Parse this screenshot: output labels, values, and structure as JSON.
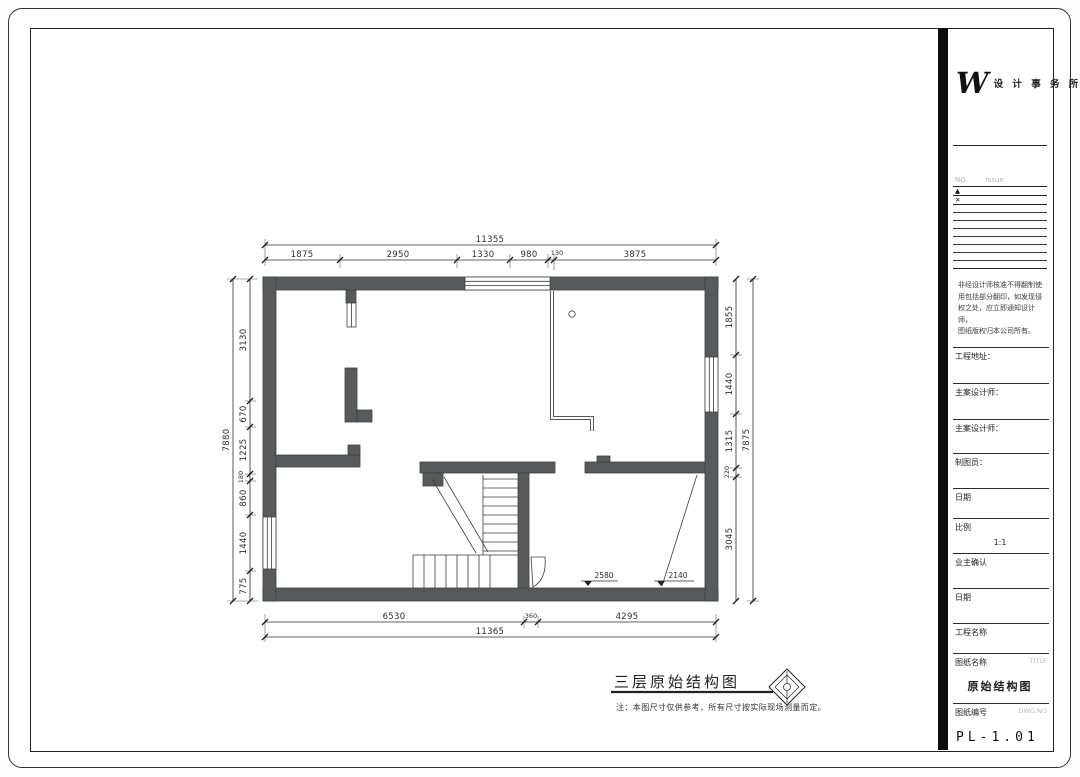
{
  "sheet": {
    "page_title": "三层原始结构图",
    "title_note": "注：本图尺寸仅供参考，所有尺寸按实际现场测量而定。",
    "wall_color": "#58595b",
    "line_color": "#3c3c3c"
  },
  "plan": {
    "dims_top": {
      "overall": "11355",
      "segments": [
        "1875",
        "2950",
        "1330",
        "980",
        "130",
        "3875"
      ]
    },
    "dims_bottom": {
      "overall": "11365",
      "segments": [
        "6530",
        "360",
        "4295"
      ]
    },
    "dims_left": {
      "overall": "7880",
      "segments": [
        "3130",
        "670",
        "1225",
        "180",
        "860",
        "1440",
        "775"
      ]
    },
    "dims_right": {
      "overall": "7875",
      "segments": [
        "1855",
        "1440",
        "1315",
        "220",
        "3045"
      ]
    },
    "levels": [
      "2580",
      "2140"
    ]
  },
  "titleblock": {
    "logo_mark": "W",
    "logo_text": "设 计 事 务 所",
    "rev_no_label": "NO.",
    "rev_issue_label": "Issue",
    "rev_marks": [
      "▲",
      "✕"
    ],
    "disclaimer_lines": [
      "非经设计师核准不得翻制使",
      "用包括部分翻印，如发现侵",
      "权之处，应立即通知设计师，",
      "图纸版权归本公司所有。"
    ],
    "fields": [
      "工程地址：",
      "主案设计师：",
      "主案设计师：",
      "制图员：",
      "日期",
      "比例",
      "业主确认",
      "日期",
      "工程名称"
    ],
    "scale_value": "1:1",
    "sheet_name_label": "图纸名称",
    "sheet_name_label_en": "TITLE",
    "sheet_name": "原始结构图",
    "sheet_no_label": "图纸编号",
    "sheet_no_label_en": "DWG.NO",
    "sheet_no": "PL-1.01"
  }
}
